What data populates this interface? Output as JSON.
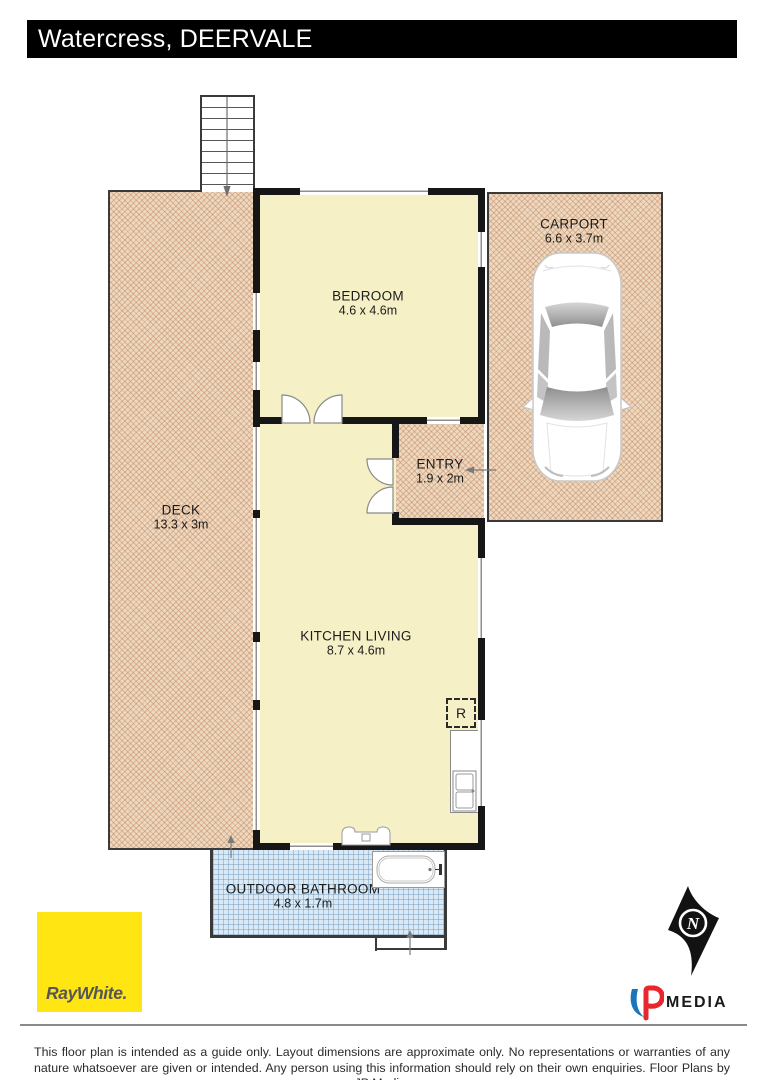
{
  "title": "Watercress, DEERVALE",
  "rooms": {
    "deck": {
      "name": "DECK",
      "dims": "13.3 x 3m"
    },
    "bedroom": {
      "name": "BEDROOM",
      "dims": "4.6 x 4.6m"
    },
    "carport": {
      "name": "CARPORT",
      "dims": "6.6 x 3.7m"
    },
    "entry": {
      "name": "ENTRY",
      "dims": "1.9 x 2m"
    },
    "kitchen_living": {
      "name": "KITCHEN LIVING",
      "dims": "8.7 x 4.6m"
    },
    "outdoor_bathroom": {
      "name": "OUTDOOR BATHROOM",
      "dims": "4.8 x 1.7m"
    }
  },
  "symbols": {
    "fridge_label": "R",
    "compass_letter": "N"
  },
  "branding": {
    "agency_wordmark": "RayWhite.",
    "media_wordmark_suffix": "MEDIA"
  },
  "disclaimer": "This floor plan is intended as a guide only. Layout dimensions are approximate only. No representations or warranties of any nature whatsoever are given or intended. Any person using this information should rely on their own enquiries. Floor Plans by JP Media.",
  "colors": {
    "wall": "#161616",
    "room_fill": "#f6f0c6",
    "outdoor_hatch_fill": "#eed8bf",
    "outdoor_hatch_line": "#ba7f58",
    "bathroom_fill": "#d9eaf6",
    "bathroom_line": "#6e96b9",
    "ray_white_yellow": "#ffe512",
    "jp_blue": "#1b75bc",
    "jp_red": "#e8262d",
    "title_bg": "#000000",
    "title_text": "#ffffff"
  }
}
